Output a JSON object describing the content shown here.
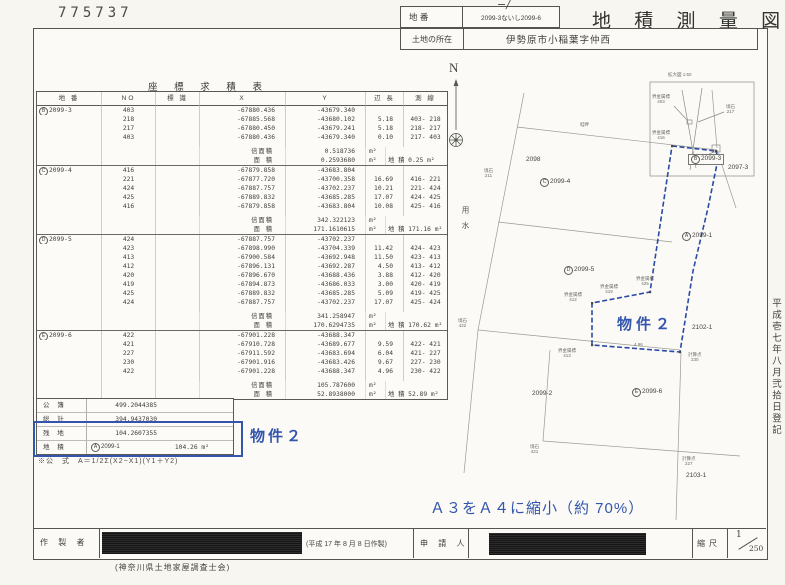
{
  "stamp": "775737",
  "header": {
    "lot_label": "地 番",
    "lot_value": "2099-3ないし2099-6",
    "lot_note": "−/",
    "title": "地 積 測 量 図",
    "location_label": "土地の所在",
    "location_value": "伊勢原市小稲葉字仲西"
  },
  "table": {
    "title": "座 標 求 積 表",
    "columns": [
      "地 番",
      "NO",
      "標 識",
      "X",
      "Y",
      "辺 長",
      "測 線"
    ],
    "double_area_label": "倍面積",
    "area_label": "面 積",
    "chiseki_label": "地 積",
    "unit": "m²",
    "blocks": [
      {
        "parcel_prefix": "B",
        "parcel": "2099-3",
        "rows": [
          [
            "403",
            "-67880.436",
            "-43679.340",
            "",
            ""
          ],
          [
            "218",
            "-67885.568",
            "-43680.102",
            "5.18",
            "403- 218"
          ],
          [
            "217",
            "-67880.450",
            "-43679.241",
            "5.18",
            "218- 217"
          ],
          [
            "403",
            "-67880.436",
            "-43679.340",
            "0.10",
            "217- 403"
          ]
        ],
        "double_area": "0.518736",
        "area": "0.2593680",
        "chiseki": "0.25"
      },
      {
        "parcel_prefix": "C",
        "parcel": "2099-4",
        "rows": [
          [
            "416",
            "-67879.858",
            "-43683.804",
            "",
            ""
          ],
          [
            "221",
            "-67877.720",
            "-43700.358",
            "16.69",
            "416- 221"
          ],
          [
            "424",
            "-67887.757",
            "-43702.237",
            "10.21",
            "221- 424"
          ],
          [
            "425",
            "-67889.832",
            "-43685.285",
            "17.07",
            "424- 425"
          ],
          [
            "416",
            "-67879.858",
            "-43683.804",
            "10.08",
            "425- 416"
          ]
        ],
        "double_area": "342.322123",
        "area": "171.1610615",
        "chiseki": "171.16"
      },
      {
        "parcel_prefix": "D",
        "parcel": "2099-5",
        "rows": [
          [
            "424",
            "-67887.757",
            "-43702.237",
            "",
            ""
          ],
          [
            "423",
            "-67898.990",
            "-43704.339",
            "11.42",
            "424- 423"
          ],
          [
            "413",
            "-67900.584",
            "-43692.948",
            "11.50",
            "423- 413"
          ],
          [
            "412",
            "-67896.131",
            "-43692.287",
            "4.50",
            "413- 412"
          ],
          [
            "420",
            "-67896.670",
            "-43688.436",
            "3.88",
            "412- 420"
          ],
          [
            "419",
            "-67894.873",
            "-43686.033",
            "3.00",
            "420- 419"
          ],
          [
            "425",
            "-67889.832",
            "-43685.285",
            "5.09",
            "419- 425"
          ],
          [
            "424",
            "-67887.757",
            "-43702.237",
            "17.07",
            "425- 424"
          ]
        ],
        "double_area": "341.258947",
        "area": "170.6294735",
        "chiseki": "170.62"
      },
      {
        "parcel_prefix": "E",
        "parcel": "2099-6",
        "rows": [
          [
            "422",
            "-67901.228",
            "-43688.347",
            "",
            ""
          ],
          [
            "421",
            "-67910.728",
            "-43689.677",
            "9.59",
            "422- 421"
          ],
          [
            "227",
            "-67911.592",
            "-43683.694",
            "6.04",
            "421- 227"
          ],
          [
            "230",
            "-67901.916",
            "-43683.426",
            "9.67",
            "227- 230"
          ],
          [
            "422",
            "-67901.228",
            "-43688.347",
            "4.96",
            "230- 422"
          ]
        ],
        "double_area": "105.787600",
        "area": "52.8938000",
        "chiseki": "52.89"
      }
    ],
    "summary": {
      "rows": [
        [
          "公 簿",
          "499.2044385"
        ],
        [
          "総 計",
          "394.9437030"
        ],
        [
          "残 地",
          "104.2607355"
        ]
      ],
      "chiseki_row": {
        "label": "地 積",
        "parcel_prefix": "A",
        "parcel": "2099-1",
        "value": "104.26",
        "unit": "m²"
      }
    },
    "formula": "※公　式　A＝1/2Σ(X2−X1)(Y1＋Y2)"
  },
  "annotations": {
    "property2": "物件２",
    "reduction_note": "Ａ３をＡ４に縮小（約 70%）",
    "registration_note": "平成壱七年八月弐拾日登記",
    "blue_color": "#3355ad"
  },
  "map": {
    "north_label": "N",
    "waterway": "用水",
    "inset_title": "拡大図 1:50",
    "parcels": [
      {
        "prefix": "",
        "label": "2098",
        "x": 86,
        "y": 98,
        "boxed": false
      },
      {
        "prefix": "C",
        "label": "2099-4",
        "x": 100,
        "y": 120,
        "boxed": false
      },
      {
        "prefix": "B",
        "label": "2099-3",
        "x": 248,
        "y": 96,
        "boxed": true
      },
      {
        "prefix": "",
        "label": "2097-3",
        "x": 288,
        "y": 106,
        "boxed": false
      },
      {
        "prefix": "D",
        "label": "2099-5",
        "x": 124,
        "y": 208,
        "boxed": false
      },
      {
        "prefix": "A",
        "label": "2099-1",
        "x": 242,
        "y": 174,
        "boxed": false
      },
      {
        "prefix": "",
        "label": "2102-1",
        "x": 252,
        "y": 266,
        "boxed": false
      },
      {
        "prefix": "",
        "label": "2099-2",
        "x": 92,
        "y": 332,
        "boxed": false
      },
      {
        "prefix": "E",
        "label": "2099-6",
        "x": 192,
        "y": 330,
        "boxed": false
      },
      {
        "prefix": "",
        "label": "2103-1",
        "x": 246,
        "y": 414,
        "boxed": false
      }
    ],
    "points": [
      {
        "label": "拡大図 1:50",
        "no": "",
        "x": 228,
        "y": 14
      },
      {
        "label": "界金属標",
        "no": "403",
        "x": 212,
        "y": 36
      },
      {
        "label": "境石",
        "no": "217",
        "x": 286,
        "y": 46
      },
      {
        "label": "境石",
        "no": "211",
        "x": 44,
        "y": 110
      },
      {
        "label": "畦畔",
        "no": "",
        "x": 140,
        "y": 64
      },
      {
        "label": "界金属標",
        "no": "416",
        "x": 212,
        "y": 72
      },
      {
        "label": "界金属標",
        "no": "425",
        "x": 196,
        "y": 218
      },
      {
        "label": "界金属標",
        "no": "419",
        "x": 160,
        "y": 226
      },
      {
        "label": "界金属標",
        "no": "412",
        "x": 124,
        "y": 234
      },
      {
        "label": "境石",
        "no": "422",
        "x": 18,
        "y": 260
      },
      {
        "label": "界金属標",
        "no": "413",
        "x": 118,
        "y": 290
      },
      {
        "label": "4.96",
        "no": "",
        "x": 194,
        "y": 284
      },
      {
        "label": "計算点",
        "no": "230",
        "x": 248,
        "y": 294
      },
      {
        "label": "境石",
        "no": "421",
        "x": 90,
        "y": 386
      },
      {
        "label": "計算点",
        "no": "227",
        "x": 242,
        "y": 398
      }
    ]
  },
  "footer": {
    "creator_label": "作 製 者",
    "date_note": "(平成 17 年 8 月 8 日作製)",
    "association": "(神奈川県土地家屋調査士会)",
    "applicant_label": "申 請 人",
    "scale_label": "縮尺",
    "scale_num": "1",
    "scale_den": "250"
  }
}
